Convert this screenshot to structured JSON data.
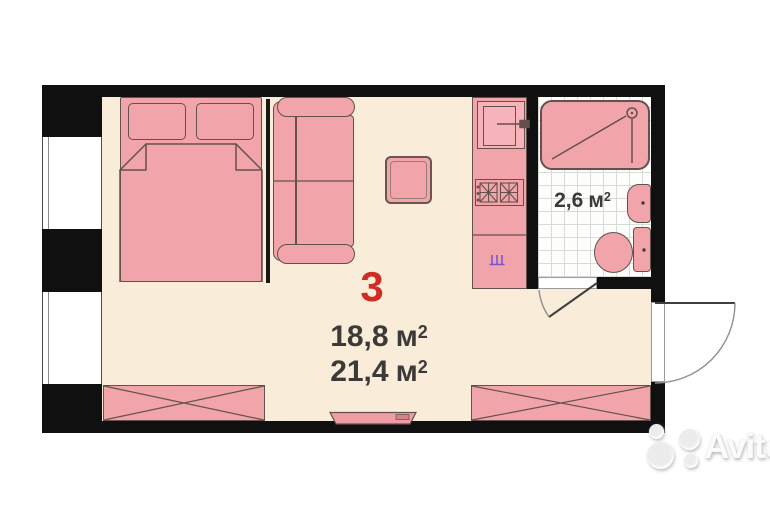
{
  "floorplan": {
    "room_number": "3",
    "areas": {
      "living": {
        "value": "18,8",
        "unit": "м",
        "sup": "2"
      },
      "total": {
        "value": "21,4",
        "unit": "м",
        "sup": "2"
      },
      "bathroom": {
        "value": "2,6",
        "unit": "м",
        "sup": "2"
      }
    },
    "colors": {
      "wall": "#101010",
      "floor": "#f9edda",
      "furniture_fill": "#f2a4ab",
      "furniture_outline": "#64504c",
      "room_number_red": "#d02c26",
      "label_text": "#3c3a38",
      "tile_line": "#d8dcd6",
      "plumbing_symbol_purple": "#7a57d1",
      "watermark_gray": "#c9c9c9"
    },
    "elements": [
      "bed",
      "pillows",
      "sofa",
      "coffee-table",
      "tv",
      "wardrobe-left",
      "wardrobe-right",
      "kitchen-block",
      "fridge",
      "stove",
      "kitchen-sink",
      "shower",
      "washbasin",
      "toilet",
      "window",
      "entry-door",
      "bathroom-door",
      "partition"
    ]
  },
  "watermark": {
    "brand": "Avito"
  }
}
